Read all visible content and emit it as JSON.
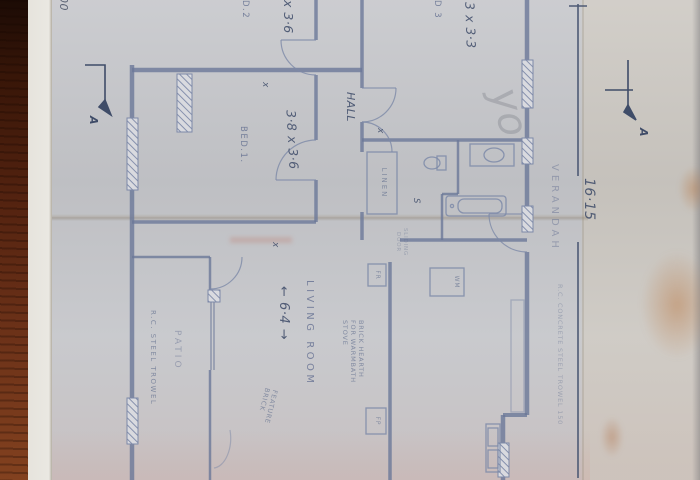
{
  "photo": {
    "wood_color": "#542310",
    "paper_color": "#c6c7cb",
    "margin_color": "#cdc9c3",
    "ink_color": "#6b7899",
    "handwriting_color": "#414e6b"
  },
  "plan": {
    "overall_dim": "16·15",
    "verandah": {
      "label": "VERANDAH",
      "spec": "R.C. CONCRETE STEEL TROWEL 150"
    },
    "rooms": {
      "bed3": {
        "label": "D 3",
        "dim": "3 x 3·3"
      },
      "bed2": {
        "label": "D.2",
        "dim": "x 3·6"
      },
      "bed1": {
        "label": "BED.1.",
        "dim": "3·8 x 3·6"
      },
      "hall": {
        "label": "HALL"
      },
      "linen": {
        "label": "LINEN"
      },
      "shelf": {
        "label": "S"
      },
      "living": {
        "label": "LIVING ROOM",
        "dim": "← 6·4 →"
      },
      "patio": {
        "label": "PATIO",
        "spec": "R.C. STEEL TROWEL"
      },
      "kitchen": {
        "washing_machine": "WM",
        "fridge": "FR",
        "fireplace": "FP",
        "sliding_door": "SLIDING DOOR"
      }
    },
    "annotations": {
      "hearth": [
        "BRICK HEARTH",
        "FOR WARMBATH",
        "STOVE"
      ],
      "feature_brick": "FEATURE BRICK",
      "section_marker": "A",
      "door_mark": "x",
      "scribble": "yo"
    },
    "dimensions_bottom": {
      "bed_wing": "3500",
      "patio_wing": "6500",
      "edge_fragment": "00"
    }
  }
}
